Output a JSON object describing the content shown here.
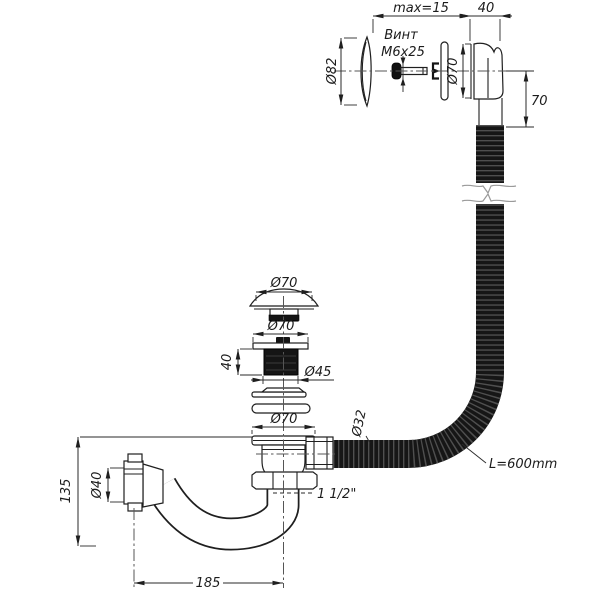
{
  "colors": {
    "background": "#ffffff",
    "line": "#1f1f1f",
    "hose_body": "#161616",
    "hose_stripe": "#4f4f4f",
    "dim_line": "#2a2a2a"
  },
  "overflow": {
    "clamp_range_label": "max=15",
    "flange_depth_label": "40",
    "screw_label_line1": "Винт",
    "screw_label_line2": "М6х25",
    "cover_plate_diameter": "Ø82",
    "body_diameter": "Ø70",
    "outlet_offset": "70"
  },
  "hose": {
    "diameter_label": "Ø32",
    "length_label": "L=600mm"
  },
  "waste": {
    "cap_diameter": "Ø70",
    "plug_diameter": "Ø70",
    "plug_height": "40",
    "plug_core_diameter": "Ø45",
    "flange_diameter": "Ø70",
    "thread_size": "1 1/2\""
  },
  "trap": {
    "nut_diameter": "Ø40",
    "height": "135",
    "length": "185"
  }
}
